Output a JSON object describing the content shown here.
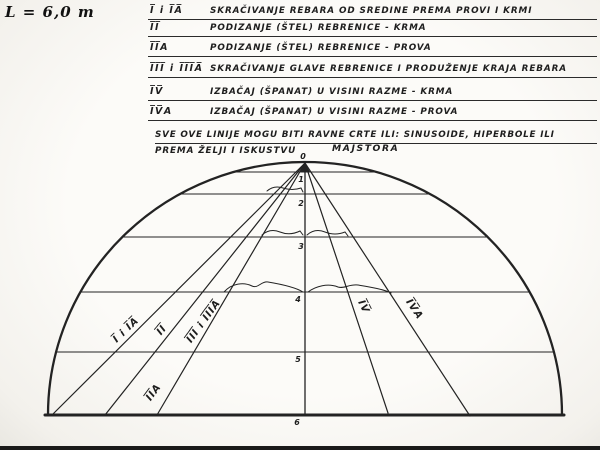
{
  "scale": {
    "label": "L = 6,0 m"
  },
  "legend": {
    "rows": [
      {
        "numeral": "I̅ i I̅A̅",
        "description": "SKRAČIVANJE REBARA OD SREDINE PREMA PROVI I KRMI"
      },
      {
        "numeral": "I̅I̅",
        "description": "PODIZANJE (ŠTEL) REBRENICE - KRMA"
      },
      {
        "numeral": "I̅I̅A",
        "description": "PODIZANJE (ŠTEL) REBRENICE - PROVA"
      },
      {
        "numeral": "I̅I̅I̅ i I̅I̅I̅A̅",
        "description": "SKRAČIVANJE GLAVE REBRENICE I PRODUŽENJE KRAJA REBARA"
      },
      {
        "numeral": "I̅V̅",
        "description": "IZBAČAJ (ŠPANAT) U VISINI RAZME - KRMA"
      },
      {
        "numeral": "I̅V̅A",
        "description": "IZBAČAJ (ŠPANAT) U VISINI RAZME - PROVA"
      }
    ],
    "note_line1": "SVE OVE LINIJE MOGU BITI RAVNE CRTE ILI: SINUSOIDE, HIPERBOLE ILI",
    "note_line2": "PREMA ŽELJI I ISKUSTVU",
    "note_line2b": "MAJSTORA"
  },
  "diagram": {
    "ink_color": "#232323",
    "ticks": [
      "0",
      "1",
      "2",
      "3",
      "4",
      "5",
      "6"
    ],
    "ray_labels": [
      {
        "text": "I̅ i I̅A̅"
      },
      {
        "text": "I̅I̅"
      },
      {
        "text": "I̅I̅I̅ i I̅I̅I̅A̅"
      },
      {
        "text": "I̅I̅A"
      },
      {
        "text": "I̅V̅"
      },
      {
        "text": "I̅V̅A"
      }
    ]
  }
}
